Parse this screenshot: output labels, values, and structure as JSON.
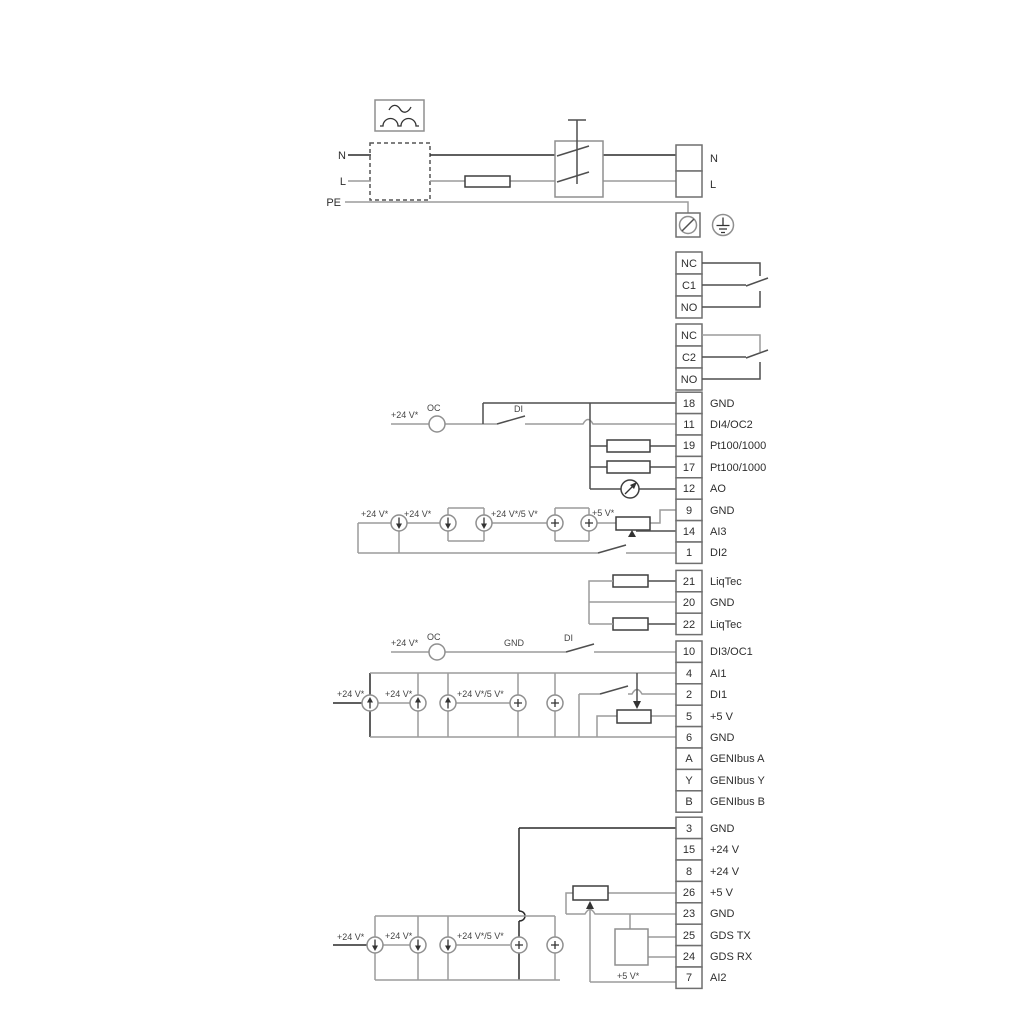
{
  "power": {
    "n_left": "N",
    "l_left": "L",
    "pe": "PE",
    "n_right": "N",
    "l_right": "L"
  },
  "relay1": [
    "NC",
    "C1",
    "NO"
  ],
  "relay2": [
    "NC",
    "C2",
    "NO"
  ],
  "io1": [
    [
      "18",
      "GND"
    ],
    [
      "11",
      "DI4/OC2"
    ],
    [
      "19",
      "Pt100/1000"
    ],
    [
      "17",
      "Pt100/1000"
    ],
    [
      "12",
      "AO"
    ],
    [
      "9",
      "GND"
    ],
    [
      "14",
      "AI3"
    ],
    [
      "1",
      "DI2"
    ]
  ],
  "io2": [
    [
      "21",
      "LiqTec"
    ],
    [
      "20",
      "GND"
    ],
    [
      "22",
      "LiqTec"
    ]
  ],
  "io3": [
    [
      "10",
      "DI3/OC1"
    ]
  ],
  "io4": [
    [
      "4",
      "AI1"
    ],
    [
      "2",
      "DI1"
    ],
    [
      "5",
      "+5 V"
    ],
    [
      "6",
      "GND"
    ],
    [
      "A",
      "GENIbus A"
    ],
    [
      "Y",
      "GENIbus Y"
    ],
    [
      "B",
      "GENIbus B"
    ]
  ],
  "io5": [
    [
      "3",
      "GND"
    ],
    [
      "15",
      "+24 V"
    ],
    [
      "8",
      "+24 V"
    ],
    [
      "26",
      "+5 V"
    ],
    [
      "23",
      "GND"
    ],
    [
      "25",
      "GDS TX"
    ],
    [
      "24",
      "GDS RX"
    ],
    [
      "7",
      "AI2"
    ]
  ],
  "ann": {
    "di4_24v": "+24 V*",
    "di4_oc": "OC",
    "di4_di": "DI",
    "ai3_24v_a": "+24 V*",
    "ai3_24v_b": "+24 V*",
    "ai3_mixed": "+24 V*/5 V*",
    "ai3_5v": "+5 V*",
    "di3_24v": "+24 V*",
    "di3_oc": "OC",
    "di3_gnd": "GND",
    "di3_di": "DI",
    "ai1_24v_a": "+24 V*",
    "ai1_24v_b": "+24 V*",
    "ai1_mixed": "+24 V*/5 V*",
    "ai2_24v_a": "+24 V*",
    "ai2_24v_b": "+24 V*",
    "ai2_mixed": "+24 V*/5 V*",
    "ai2_5v": "+5 V*"
  },
  "colors": {
    "wire": "#9c9c9c",
    "wire_dark": "#4f4f4f",
    "wire_black": "#2a2a2a",
    "component": "#3f3f3f",
    "text": "#2e2e2e"
  }
}
